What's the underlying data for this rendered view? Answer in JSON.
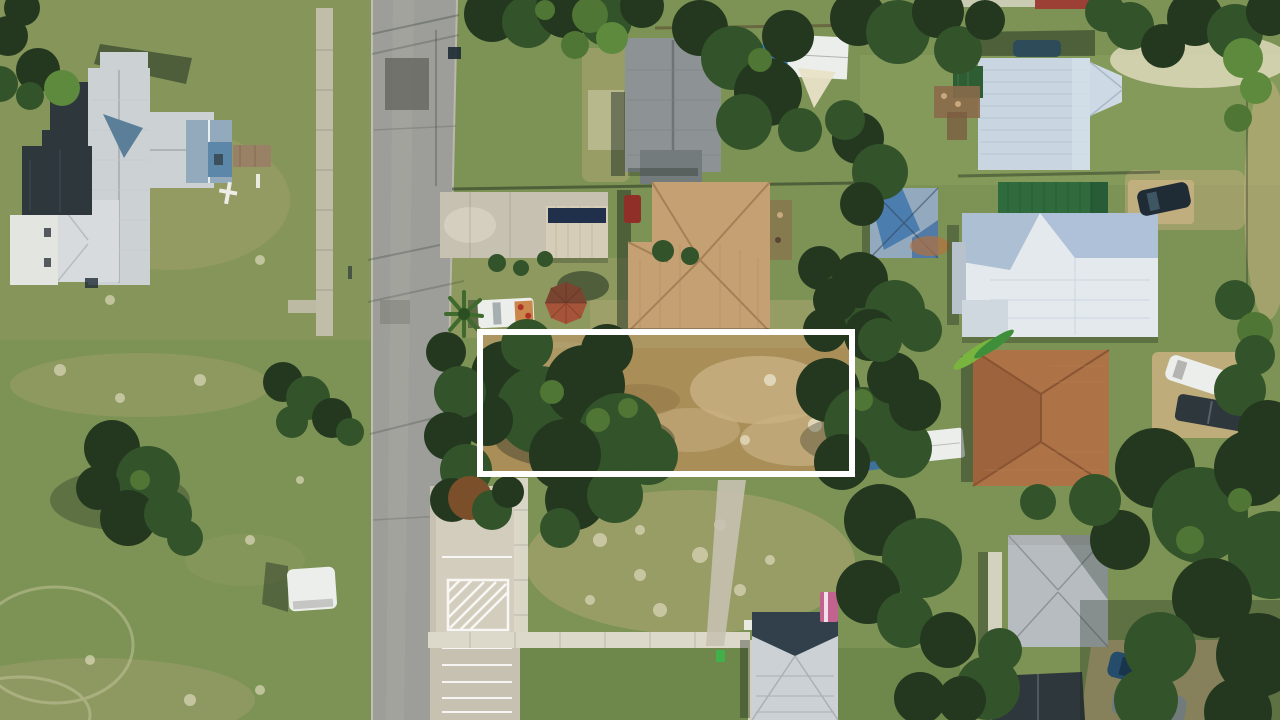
{
  "scene": {
    "type": "aerial-photograph",
    "description": "Aerial drone view of a residential neighborhood; a vacant dirt lot between houses is outlined with a white rectangle annotation",
    "width_px": 1280,
    "height_px": 720
  },
  "lot_highlight": {
    "x": 480,
    "y": 332,
    "width": 372,
    "height": 142,
    "stroke_width": 6,
    "color": "#ffffff"
  },
  "colors": {
    "grass_base": "#7d9355",
    "grass_light": "#9cae6a",
    "grass_dark": "#5e7c40",
    "grass_dry": "#b3a878",
    "grass_pale": "#d6d2ac",
    "road": "#9d9d99",
    "road_light": "#b0afa9",
    "road_dark": "#787771",
    "road_patch": "#6d6d67",
    "concrete": "#c6c1b0",
    "concrete_bright": "#ddd9ca",
    "dirt": "#a98e58",
    "dirt_dark": "#8a6f42",
    "dirt_light": "#c9b183",
    "dirt_pale": "#e9e2c8",
    "tree_dark": "#24381f",
    "tree_mid": "#33532a",
    "tree_bright": "#4f7634",
    "palm": "#5d8a3c",
    "shadow": "#16231a",
    "roof_white": "#ccd1d4",
    "roof_white_bright": "#e6e8e9",
    "charcoal": "#2e373c",
    "roof_slate": "#31404b",
    "roof_gray": "#8d9295",
    "roof_gray_light": "#b6bcc0",
    "roof_blue": "#c9d6e2",
    "roof_blue_mid": "#9fb4cc",
    "roof_green": "#2f6b3c",
    "steel": "#5b7f99",
    "roof_tan": "#c4a072",
    "roof_tan_dark": "#9c7a4e",
    "roof_brown": "#ad7246",
    "roof_brown_dark": "#875231",
    "terracotta": "#a5543a",
    "tarp": "#2e7ecf",
    "tarp2": "#3a6ea5",
    "van_white": "#eceeec",
    "car_navy": "#1f2b35",
    "car_blue": "#2b5d8f",
    "car_gray": "#98a1a6",
    "red_roof": "#9c4036",
    "green_box": "#3db54a",
    "pink": "#c2628f",
    "white": "#ffffff"
  }
}
